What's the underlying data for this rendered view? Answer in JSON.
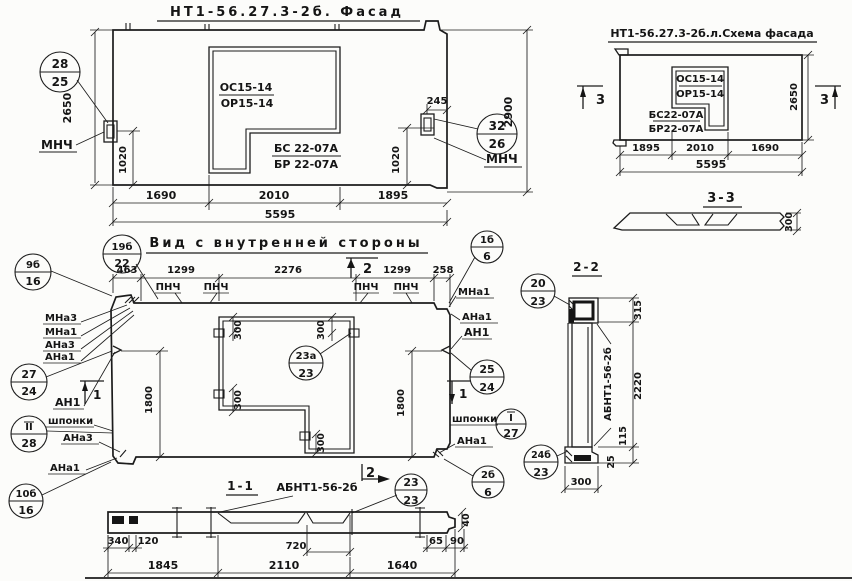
{
  "facade": {
    "title": "НТ1-56.27.3-2б. Фасад",
    "opening_top_a": "ОС15-14",
    "opening_top_b": "ОР15-14",
    "opening_bot_a": "БС 22-07А",
    "opening_bot_b": "БР 22-07А",
    "dim_height_left": "2650",
    "dim_height_right": "2900",
    "dim_anchor_left": "1020",
    "dim_anchor_right": "1020",
    "dim_anchor_top": "245",
    "dim_w1": "1690",
    "dim_w2": "2010",
    "dim_w3": "1895",
    "dim_total": "5595",
    "callout_left_top": "28",
    "callout_left_bot": "25",
    "callout_right_top": "32",
    "callout_right_bot": "26",
    "anchor_label_left": "МНЧ",
    "anchor_label_right": "МНЧ"
  },
  "schema": {
    "title": "НТ1-56.27.3-2б.л.Схема фасада",
    "opening_top_a": "ОС15-14",
    "opening_top_b": "ОР15-14",
    "opening_bot_a": "БС22-07А",
    "opening_bot_b": "БР22-07А",
    "marker_left": "3",
    "marker_right": "3",
    "dim_height": "2650",
    "dim_w1": "1895",
    "dim_w2": "2010",
    "dim_w3": "1690",
    "dim_total": "5595",
    "section_title": "3-3",
    "section_thickness": "300"
  },
  "inner": {
    "title": "Вид с внутренней стороны",
    "dim_t1": "463",
    "dim_t2": "1299",
    "dim_t3": "2276",
    "dim_t4": "1299",
    "dim_t5": "258",
    "pnch1": "ПНЧ",
    "pnch2": "ПНЧ",
    "pnch3": "ПНЧ",
    "pnch4": "ПНЧ",
    "marker_top": "2",
    "marker_bottom": "2",
    "marker_left": "1",
    "marker_right": "1",
    "dim_left_h": "1800",
    "dim_right_h": "1800",
    "dim_o1": "300",
    "dim_o2": "300",
    "dim_o3": "300",
    "dim_o4": "300",
    "callout_19b_top": "19б",
    "callout_19b_bot": "22",
    "callout_9b_top": "9б",
    "callout_9b_bot": "16",
    "callout_27_top": "27",
    "callout_27_bot": "24",
    "callout_11_top": "II",
    "callout_11_bot": "28",
    "callout_10b_top": "10б",
    "callout_10b_bot": "16",
    "callout_1b_top": "1б",
    "callout_1b_bot": "6",
    "callout_25_top": "25",
    "callout_25_bot": "24",
    "callout_1_top": "I",
    "callout_1_bot": "27",
    "callout_2b_top": "2б",
    "callout_2b_bot": "6",
    "callout_23a_top": "23а",
    "callout_23a_bot": "23",
    "lbl_mna3": "МНа3",
    "lbl_mna1": "МНа1",
    "lbl_ana3": "АНа3",
    "lbl_ana1": "АНа1",
    "lbl_an1_left": "АН1",
    "lbl_shponki_left": "шпонки",
    "lbl_ana3_low": "АНа3",
    "lbl_ana1_low": "АНа1",
    "lbl_mna1_r": "МНа1",
    "lbl_ana1_r": "АНа1",
    "lbl_an1_r": "АН1",
    "lbl_shponki_r": "шпонки",
    "lbl_ana1_r2": "АНа1"
  },
  "sec11": {
    "title": "1-1",
    "subtitle": "АБНТ1-56-2б",
    "callout_top": "23",
    "callout_bot": "23",
    "d340": "340",
    "d120": "120",
    "d720": "720",
    "d65": "65",
    "d90": "90",
    "d40": "40",
    "d1845": "1845",
    "d2110": "2110",
    "d1640": "1640"
  },
  "sec22": {
    "title": "2-2",
    "label": "АБНТ1-56-2б",
    "callout_20_top": "20",
    "callout_20_bot": "23",
    "callout_24b_top": "24б",
    "callout_24b_bot": "23",
    "d315": "315",
    "d2220": "2220",
    "d115": "115",
    "d25": "25",
    "d300": "300"
  }
}
